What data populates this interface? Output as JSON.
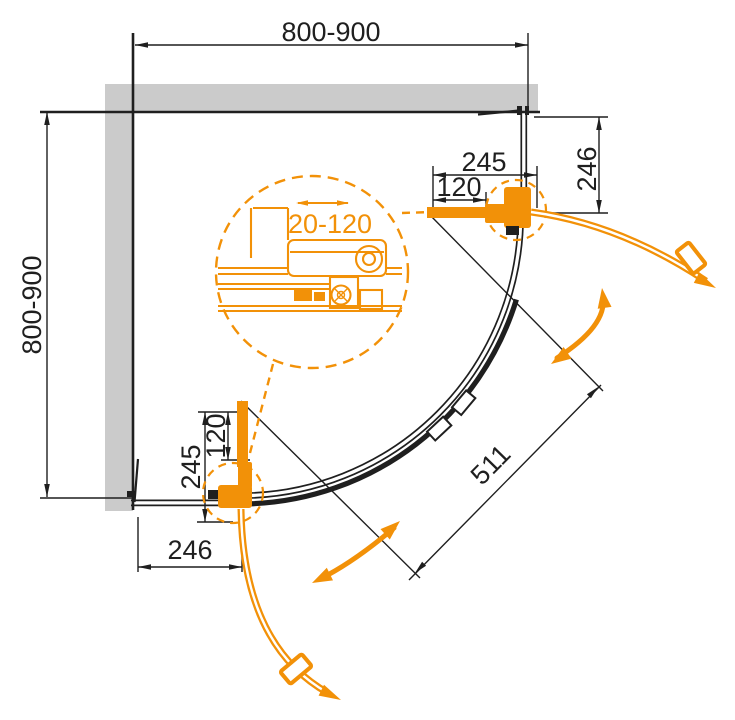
{
  "drawing": {
    "title": "Quadrant shower enclosure - plan view technical drawing",
    "dims": {
      "top_width": "800-900",
      "left_depth": "800-900",
      "right_fixed_panel": "246",
      "top_hinge_span": "245",
      "top_pivot_offset": "120",
      "bottom_hinge_span": "245",
      "bottom_pivot_offset": "120",
      "bottom_fixed_panel": "246",
      "diagonal_opening": "511",
      "profile_adjustment": "20-120"
    },
    "colors": {
      "accent": "#F29108",
      "line": "#1F1F1F",
      "wall": "#CBCBCB",
      "bg": "#FFFFFF"
    }
  }
}
